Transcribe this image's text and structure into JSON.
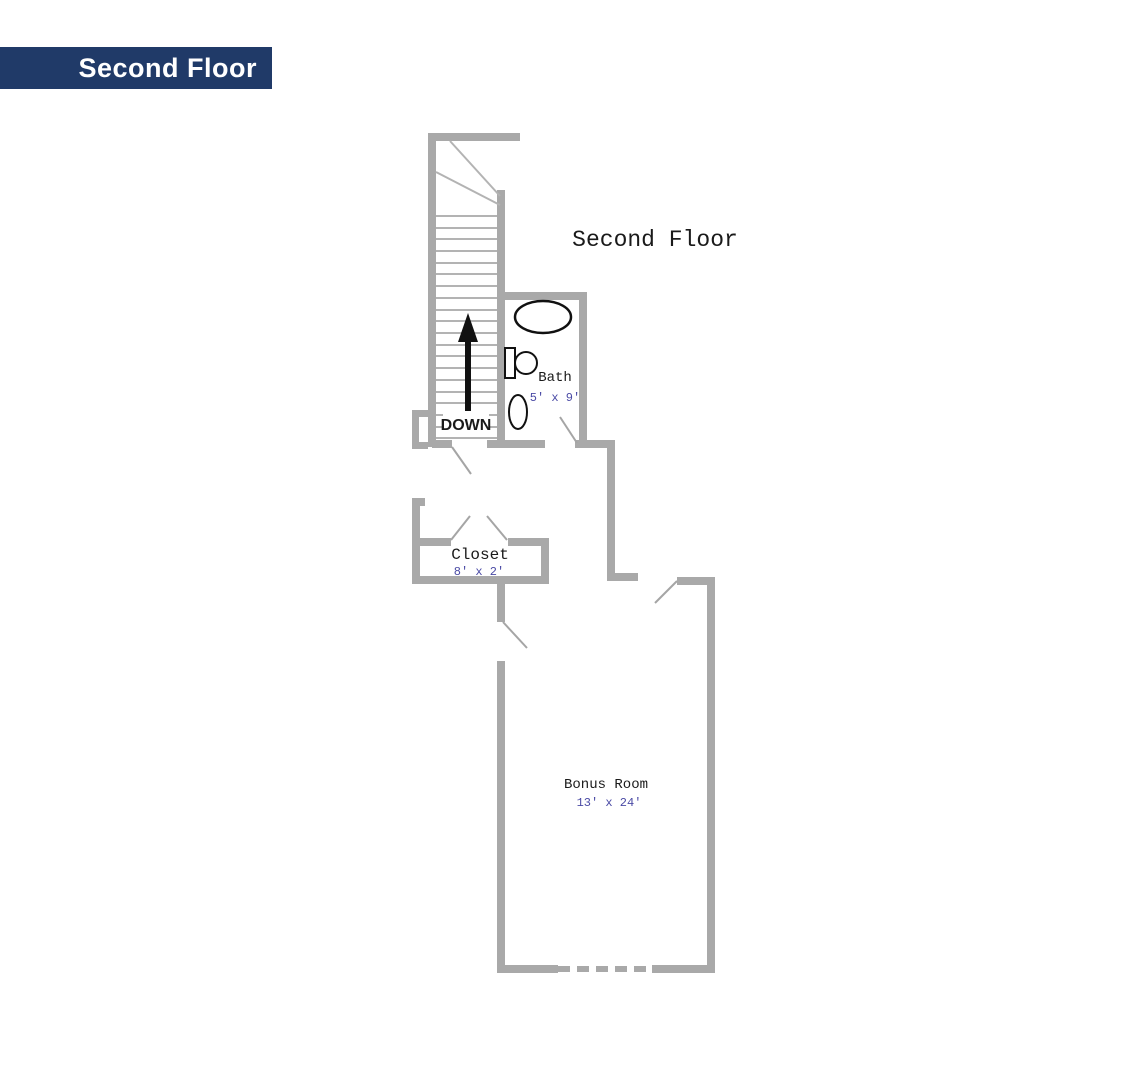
{
  "banner": {
    "label": "Second Floor",
    "bg_color": "#203a68",
    "text_color": "#ffffff"
  },
  "plan": {
    "title": "Second Floor",
    "stairs_label": "DOWN",
    "rooms": {
      "bath": {
        "name": "Bath",
        "dims": "5' x 9'"
      },
      "closet": {
        "name": "Closet",
        "dims": "8' x 2'"
      },
      "bonus": {
        "name": "Bonus Room",
        "dims": "13' x 24'"
      }
    },
    "colors": {
      "wall": "#a9a9a9",
      "stair_line": "#b3b3b3",
      "door_line": "#a5a5a5",
      "fixture": "#111111",
      "label": "#1a1a1a",
      "dimension": "#4a4aa5"
    }
  }
}
